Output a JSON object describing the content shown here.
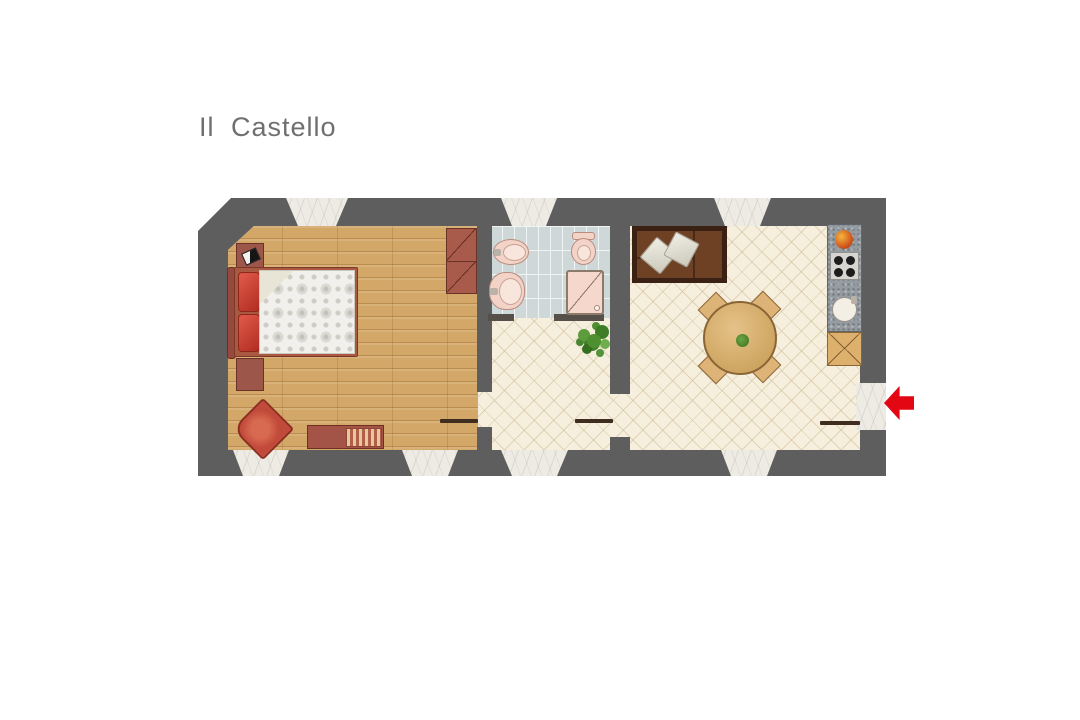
{
  "page": {
    "title": "Il Castello"
  },
  "floorplan": {
    "entrance": {
      "side": "right",
      "indicator": "red-arrow",
      "arrow_color": "#e30613"
    },
    "rooms": [
      {
        "name": "bedroom",
        "floor": "wood-parquet"
      },
      {
        "name": "bathroom",
        "floor": "blue-grey-tile"
      },
      {
        "name": "hallway",
        "floor": "ceramic-diamond-tile"
      },
      {
        "name": "living-room-kitchen",
        "floor": "ceramic-diamond-tile"
      }
    ],
    "furniture": {
      "bedroom": [
        "nightstand",
        "double-bed",
        "wardrobe",
        "armchair",
        "bench"
      ],
      "bathroom": [
        "bidet",
        "washbasin",
        "toilet",
        "shower"
      ],
      "hallway": [
        "plant"
      ],
      "living_room_kitchen": [
        "sofa",
        "cushions",
        "round-dining-table",
        "four-chairs",
        "kitchen-counter",
        "stove",
        "sink",
        "cabinet"
      ]
    },
    "colors": {
      "wall": "#5e5e5e",
      "wood_floor": "#d3a768",
      "ceramic_floor": "#f7efde",
      "bath_tile": "#cfd8d9",
      "marble": "#edebe4",
      "furniture_red": "#c24a3c",
      "sofa_brown": "#6f4124",
      "table_tan": "#d9b474",
      "arrow_red": "#e30613"
    }
  }
}
